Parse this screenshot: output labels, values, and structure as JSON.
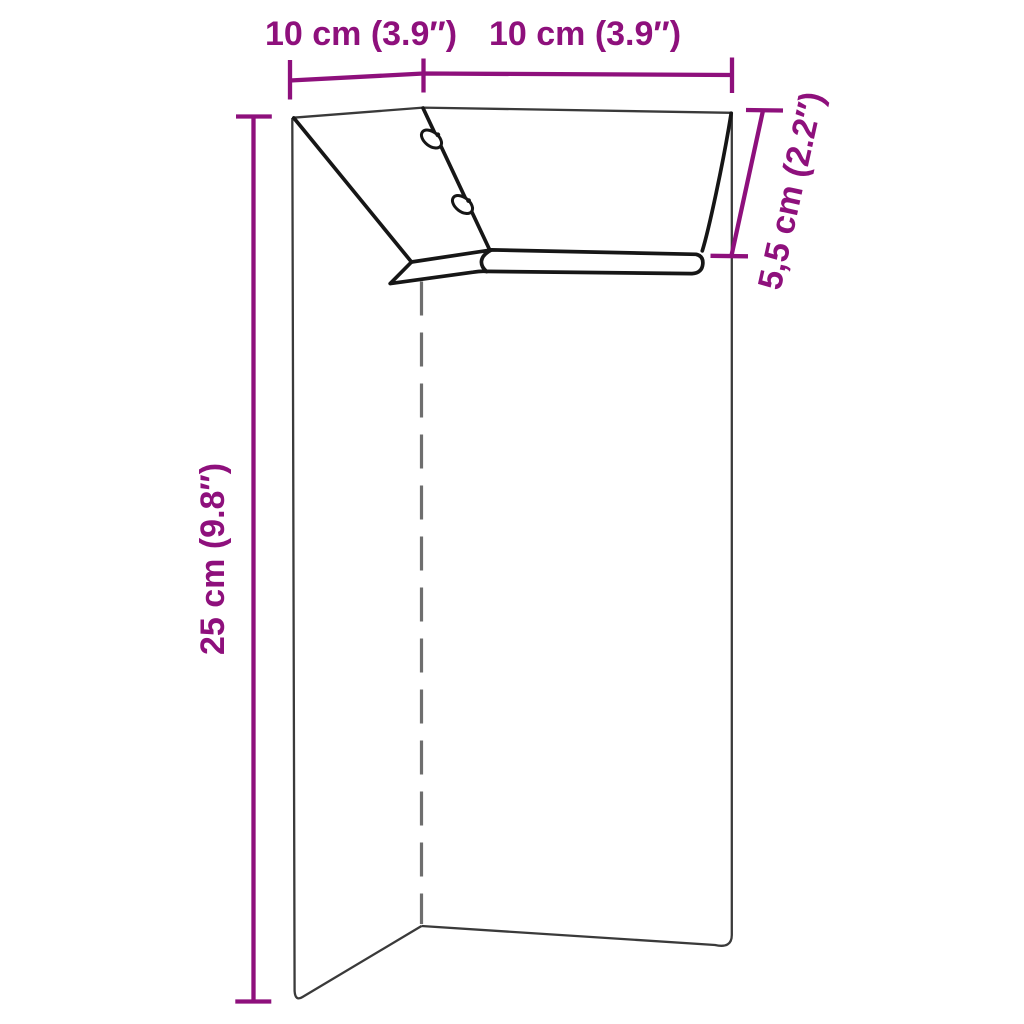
{
  "canvas": {
    "width": 1024,
    "height": 1024,
    "background": "#ffffff"
  },
  "colors": {
    "dimension": "#8E107C",
    "outline_bold": "#161616",
    "outline_thin": "#3A3A3A",
    "crease": "#6E6E6E",
    "slot_fill": "#ffffff"
  },
  "labels": {
    "top_left_width": "10 cm (3.9″)",
    "top_right_width": "10 cm (3.9″)",
    "flange_depth": "5,5 cm (2.2″)",
    "panel_height": "25 cm (9.8″)"
  },
  "values": {
    "top_left_width": {
      "cm": "10",
      "inches": "3.9"
    },
    "top_right_width": {
      "cm": "10",
      "inches": "3.9"
    },
    "flange_depth": {
      "cm": "5,5",
      "inches": "2.2"
    },
    "panel_height": {
      "cm": "25",
      "inches": "9.8"
    }
  }
}
